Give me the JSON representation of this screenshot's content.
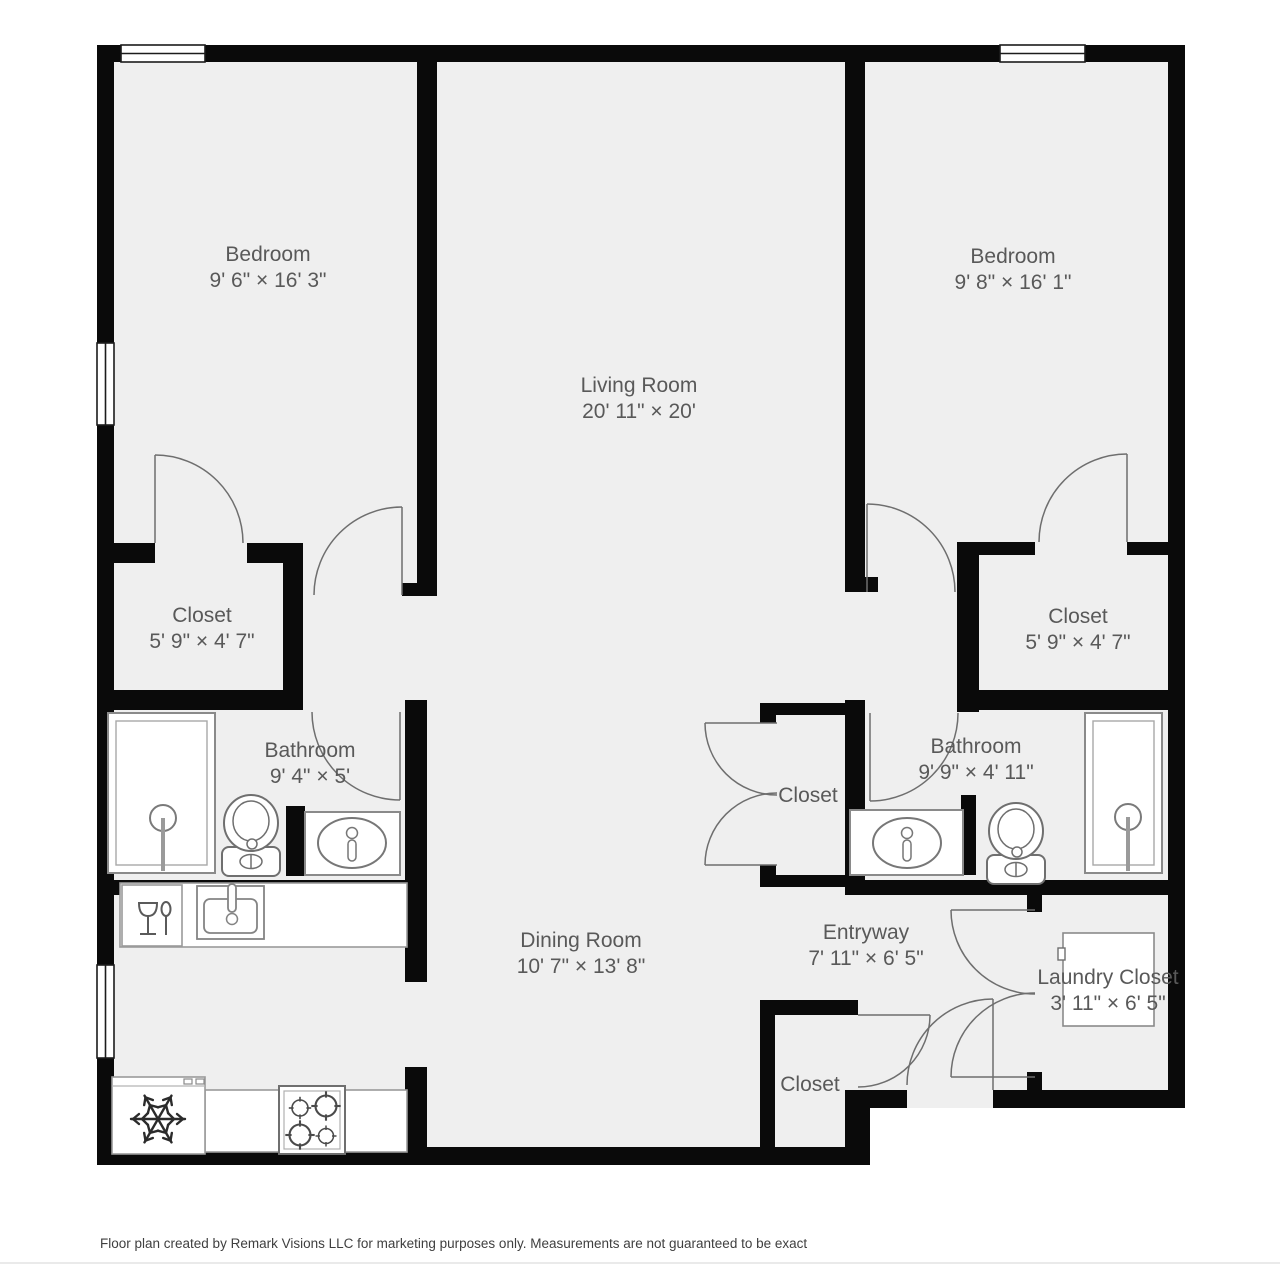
{
  "plan": {
    "rooms": [
      {
        "id": "bedroom-left",
        "name": "Bedroom",
        "dims": "9' 6\" × 16' 3\""
      },
      {
        "id": "living-room",
        "name": "Living Room",
        "dims": "20' 11\" × 20'"
      },
      {
        "id": "bedroom-right",
        "name": "Bedroom",
        "dims": "9' 8\" × 16' 1\""
      },
      {
        "id": "closet-left",
        "name": "Closet",
        "dims": "5' 9\" × 4' 7\""
      },
      {
        "id": "closet-right",
        "name": "Closet",
        "dims": "5' 9\" × 4' 7\""
      },
      {
        "id": "bathroom-left",
        "name": "Bathroom",
        "dims": "9' 4\" × 5'"
      },
      {
        "id": "bathroom-right",
        "name": "Bathroom",
        "dims": "9' 9\" × 4' 11\""
      },
      {
        "id": "closet-center",
        "name": "Closet"
      },
      {
        "id": "dining-room",
        "name": "Dining Room",
        "dims": "10' 7\" × 13' 8\""
      },
      {
        "id": "entryway",
        "name": "Entryway",
        "dims": "7' 11\" × 6' 5\""
      },
      {
        "id": "laundry-closet",
        "name": "Laundry Closet",
        "dims": "3' 11\" × 6' 5\""
      },
      {
        "id": "closet-bottom",
        "name": "Closet"
      }
    ],
    "fixtures": [
      "shower",
      "toilet",
      "vanity-sink",
      "kitchen-sink",
      "dishwasher",
      "refrigerator",
      "stove",
      "washer-dryer",
      "window",
      "door"
    ],
    "colors": {
      "wall": "#0a0a0a",
      "floor": "#efefef",
      "label_text": "#595959",
      "fixture_outline": "#777777",
      "footer_text": "#3f3f3f"
    },
    "footer": "Floor plan created by Remark Visions LLC for marketing purposes only. Measurements are not guaranteed to be exact"
  }
}
